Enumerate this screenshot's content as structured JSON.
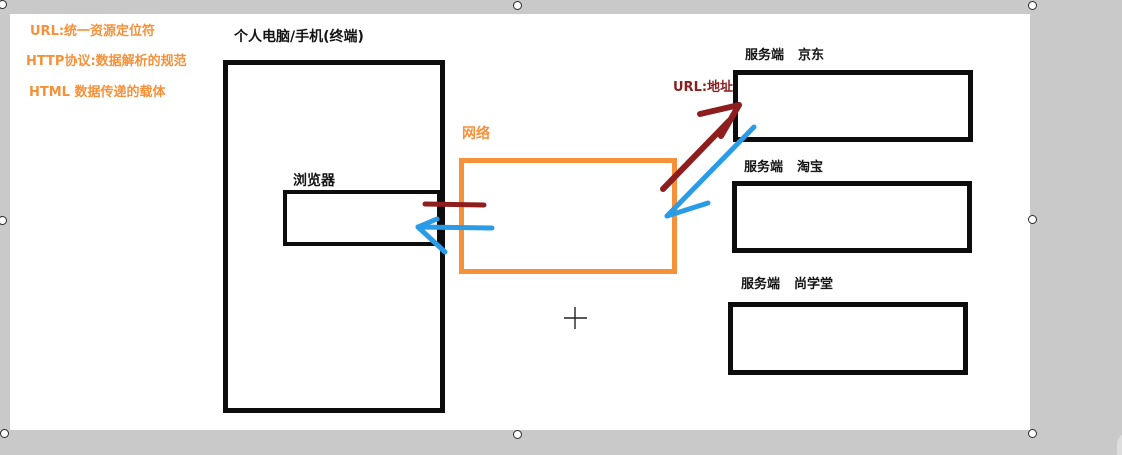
{
  "colors": {
    "orange": "#f5913a",
    "dark_red": "#8e1e1e",
    "blue": "#2a9be6",
    "ink_black": "#0d0d0d",
    "canvas_bg": "#ffffff",
    "frame_bg": "#c9c9c9"
  },
  "notes": {
    "line1": "URL:统一资源定位符",
    "line2": "HTTP协议:数据解析的规范",
    "line3": "HTML 数据传递的载体"
  },
  "diagram": {
    "terminal_label": "个人电脑/手机(终端)",
    "browser_label": "浏览器",
    "network_label": "网络",
    "url_label": "URL:地址",
    "servers": [
      {
        "prefix": "服务端",
        "name": "京东"
      },
      {
        "prefix": "服务端",
        "name": "淘宝"
      },
      {
        "prefix": "服务端",
        "name": "尚学堂"
      }
    ]
  }
}
